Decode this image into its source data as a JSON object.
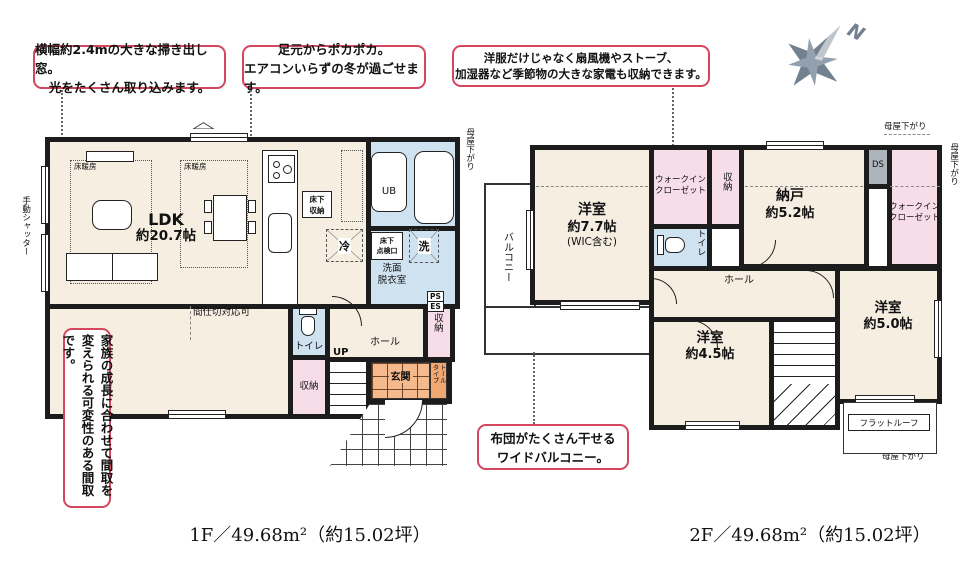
{
  "captions": {
    "f1": "1F／49.68m²（約15.02坪）",
    "f2": "2F／49.68m²（約15.02坪）"
  },
  "compass": {
    "north": "N"
  },
  "callouts": {
    "window": {
      "line1": "横幅約2.4mの大きな掃き出し窓。",
      "line2": "光をたくさん取り込みます。"
    },
    "heating": {
      "line1": "足元からポカポカ。",
      "line2": "エアコンいらずの冬が過ごせます。"
    },
    "storage": {
      "line1": "洋服だけじゃなく扇風機やストーブ、",
      "line2": "加湿器など季節物の大きな家電も収納できます。"
    },
    "flexible": {
      "line1": "家族の成長に合わせて間取を",
      "line2": "変えられる可変性のある間取です。"
    },
    "futon": {
      "line1": "布団がたくさん干せる",
      "line2": "ワイドバルコニー。"
    }
  },
  "f1": {
    "ldk_name": "LDK",
    "ldk_size": "約20.7帖",
    "floor_heating": "床暖房",
    "underfloor_storage_l1": "床下",
    "underfloor_storage_l2": "収納",
    "inspection_l1": "床下",
    "inspection_l2": "点検口",
    "fridge": "冷",
    "ub": "UB",
    "washer": "洗",
    "washroom_l1": "洗面",
    "washroom_l2": "脱衣室",
    "ps": "PS",
    "es": "ES",
    "toilet": "トイレ",
    "up": "UP",
    "hall": "ホール",
    "storage_hall": "収納",
    "storage_toilet": "収納",
    "entrance": "玄関",
    "tall_l1": "トール",
    "tall_l2": "タイプ",
    "partition": "間仕切対応可",
    "shutter": "手動シャッター"
  },
  "f2": {
    "bed1_name": "洋室",
    "bed1_size": "約7.7帖",
    "bed1_note": "(WIC含む)",
    "wic_l1": "ウォークイン",
    "wic_l2": "クローゼット",
    "storage": "収納",
    "nando_name": "納戸",
    "nando_size": "約5.2帖",
    "ds": "DS",
    "toilet": "トイレ",
    "hall": "ホール",
    "dn": "DN",
    "bed2_name": "洋室",
    "bed2_size": "約4.5帖",
    "bed3_name": "洋室",
    "bed3_size": "約5.0帖",
    "balcony": "バルコニー",
    "flat_roof": "フラットルーフ",
    "moya": "母屋下がり"
  }
}
